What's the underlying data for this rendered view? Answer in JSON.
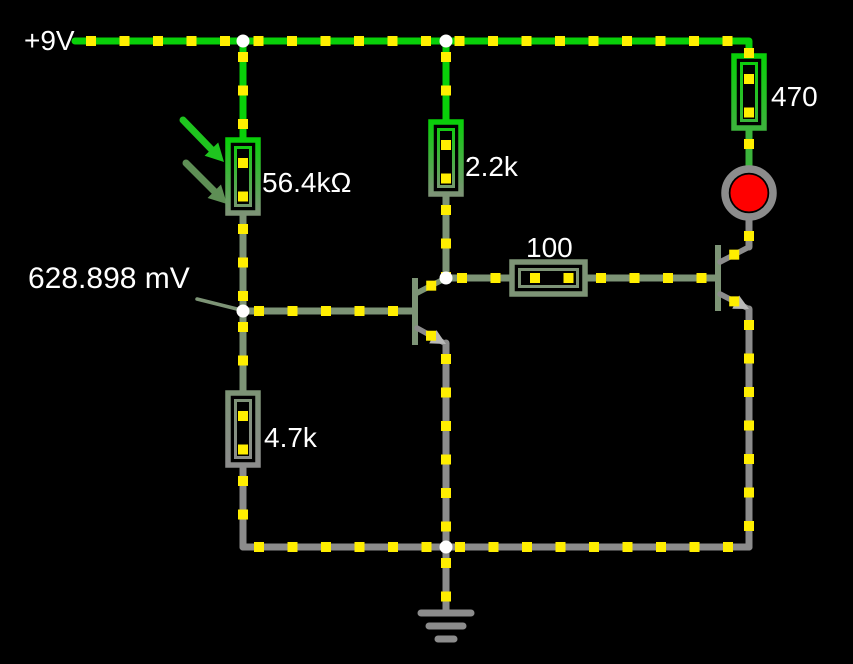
{
  "app": {
    "name": "circuit-simulator-canvas",
    "background": "#000000"
  },
  "labels": {
    "supply": "+9V",
    "photoresistor": "56.4kΩ",
    "r_collector": "2.2k",
    "r_led": "470",
    "r_base2": "100",
    "r_emitter": "4.7k",
    "probe": "628.898 mV"
  },
  "colors": {
    "hot": "#09D009",
    "mid": "#3CB43C",
    "sage": "#7D9476",
    "gray": "#8C8C8C",
    "light_gray": "#B8B8B8",
    "dot": "#FFEE00",
    "junction": "#FFFFFF",
    "led_red": "#FF0000",
    "led_ring": "#8C8C8C",
    "text": "#FFFFFF",
    "arrow1": "#1FC41F",
    "arrow2": "#5E8F55"
  },
  "circuit": {
    "wire_width": 7,
    "dot_step": 33.5,
    "dot_phase": 16,
    "dot_size": 10,
    "junction_r": 6.5,
    "wires": [
      {
        "name": "wire-supply-rail",
        "color": "hot",
        "pts": [
          [
            75,
            41
          ],
          [
            749,
            41
          ],
          [
            749,
            56
          ]
        ]
      },
      {
        "name": "wire-photoresistor-top",
        "color": "hot",
        "pts": [
          [
            243,
            41
          ],
          [
            243,
            140
          ]
        ]
      },
      {
        "name": "wire-photoresistor-bottom",
        "color": "sage",
        "pts": [
          [
            243,
            213
          ],
          [
            243,
            311
          ]
        ]
      },
      {
        "name": "wire-q1-base",
        "color": "sage",
        "pts": [
          [
            243,
            311
          ],
          [
            414,
            311
          ]
        ]
      },
      {
        "name": "wire-r4.7k-top",
        "color": "sage",
        "pts": [
          [
            243,
            311
          ],
          [
            243,
            393
          ]
        ]
      },
      {
        "name": "wire-r4.7k-bottom",
        "color": "gray",
        "pts": [
          [
            243,
            465
          ],
          [
            243,
            547
          ]
        ]
      },
      {
        "name": "wire-ground-rail",
        "color": "gray",
        "pts": [
          [
            243,
            547
          ],
          [
            749,
            547
          ]
        ]
      },
      {
        "name": "wire-r2.2k-top",
        "color": "hot",
        "pts": [
          [
            446,
            41
          ],
          [
            446,
            122
          ]
        ]
      },
      {
        "name": "wire-r2.2k-bottom",
        "color": "sage",
        "pts": [
          [
            446,
            194
          ],
          [
            446,
            278
          ]
        ]
      },
      {
        "name": "wire-r100-left",
        "color": "sage",
        "pts": [
          [
            446,
            278
          ],
          [
            512,
            278
          ]
        ]
      },
      {
        "name": "wire-r100-right",
        "color": "sage",
        "pts": [
          [
            585,
            278
          ],
          [
            716,
            278
          ]
        ]
      },
      {
        "name": "wire-q1-emitter",
        "color": "gray",
        "pts": [
          [
            446,
            343
          ],
          [
            446,
            547
          ]
        ]
      },
      {
        "name": "wire-r470-led",
        "color": "mid",
        "pts": [
          [
            749,
            128
          ],
          [
            749,
            168
          ]
        ]
      },
      {
        "name": "wire-led-q2",
        "color": "gray",
        "pts": [
          [
            749,
            220
          ],
          [
            749,
            247
          ]
        ]
      },
      {
        "name": "wire-q2-emitter",
        "color": "gray",
        "pts": [
          [
            749,
            309
          ],
          [
            749,
            547
          ]
        ]
      },
      {
        "name": "wire-ground-stem",
        "color": "gray",
        "pts": [
          [
            446,
            547
          ],
          [
            446,
            610
          ]
        ]
      }
    ],
    "dot_paths": [
      [
        [
          243,
          147
        ],
        [
          243,
          206
        ]
      ],
      [
        [
          446,
          129
        ],
        [
          446,
          187
        ]
      ],
      [
        [
          749,
          63
        ],
        [
          749,
          121
        ]
      ],
      [
        [
          243,
          400
        ],
        [
          243,
          458
        ]
      ],
      [
        [
          519,
          278
        ],
        [
          578,
          278
        ]
      ]
    ],
    "resistors": [
      {
        "name": "photoresistor-56.4k",
        "x": 228,
        "y": 140,
        "w": 30,
        "h": 73,
        "orient": "v",
        "grad": [
          "hot",
          "sage"
        ]
      },
      {
        "name": "resistor-2.2k",
        "x": 431,
        "y": 122,
        "w": 30,
        "h": 72,
        "orient": "v",
        "grad": [
          "hot",
          "sage"
        ]
      },
      {
        "name": "resistor-470",
        "x": 734,
        "y": 56,
        "w": 30,
        "h": 72,
        "orient": "v",
        "grad": [
          "hot",
          "mid"
        ]
      },
      {
        "name": "resistor-4.7k",
        "x": 228,
        "y": 393,
        "w": 30,
        "h": 72,
        "orient": "v",
        "grad": [
          "sage",
          "gray"
        ]
      },
      {
        "name": "resistor-100",
        "x": 512,
        "y": 262,
        "w": 73,
        "h": 32,
        "orient": "h",
        "grad": [
          "sage",
          "sage"
        ]
      }
    ],
    "transistors": [
      {
        "name": "transistor-q1",
        "bar": [
          415,
          278,
          415,
          345
        ],
        "coll": [
          [
            417,
            293
          ],
          [
            446,
            278
          ]
        ],
        "emit": [
          [
            417,
            328
          ],
          [
            446,
            344
          ]
        ],
        "bar_color": "sage",
        "coll_color": "sage",
        "emit_color": "gray"
      },
      {
        "name": "transistor-q2",
        "bar": [
          718,
          245,
          718,
          311
        ],
        "coll": [
          [
            720,
            262
          ],
          [
            749,
            247
          ]
        ],
        "emit": [
          [
            720,
            294
          ],
          [
            749,
            309
          ]
        ],
        "bar_color": "sage",
        "coll_color": "gray",
        "emit_color": "gray"
      }
    ],
    "led": {
      "name": "led-indicator",
      "cx": 749,
      "cy": 193,
      "ring_r": 24,
      "ring_w": 7.5,
      "red_r": 18.5
    },
    "ground": {
      "w": 7,
      "bars": [
        [
          421,
          613,
          471,
          613
        ],
        [
          429,
          626,
          463,
          626
        ],
        [
          438,
          639,
          454,
          639
        ]
      ]
    },
    "junctions": [
      [
        243,
        41
      ],
      [
        446,
        41
      ],
      [
        243,
        311
      ],
      [
        446,
        278
      ],
      [
        446,
        547
      ]
    ],
    "probe_pointer": [
      [
        197,
        299
      ],
      [
        241,
        310
      ]
    ],
    "photo_arrows": [
      {
        "shaft": [
          [
            183,
            120
          ],
          [
            212,
            150
          ]
        ],
        "tip": [
          224,
          162
        ],
        "color": "arrow1"
      },
      {
        "shaft": [
          [
            186,
            163
          ],
          [
            215,
            192
          ]
        ],
        "tip": [
          227,
          204
        ],
        "color": "arrow2"
      }
    ]
  }
}
